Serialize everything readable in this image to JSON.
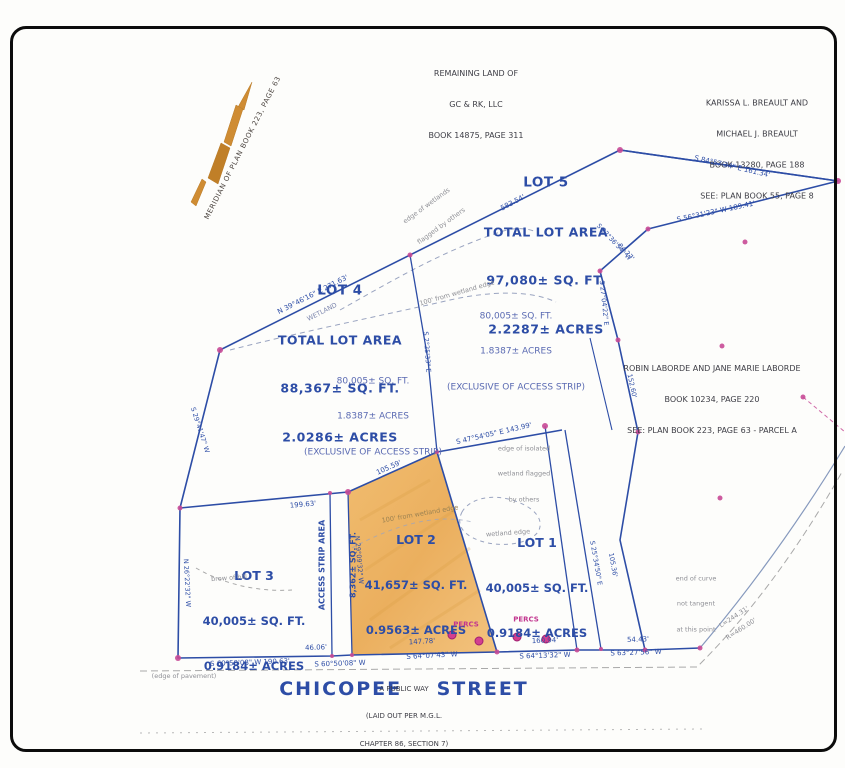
{
  "colors": {
    "ink_blue": "#2d4da6",
    "lot_fill_orange": "#edb266",
    "marker_pink": "#c2368f",
    "north_arrow_orange": "#cf8c33"
  },
  "abutters": {
    "remaining": [
      "REMAINING LAND OF",
      "GC & RK, LLC",
      "BOOK 14875, PAGE 311"
    ],
    "breault": [
      "KARISSA L. BREAULT AND",
      "MICHAEL J. BREAULT",
      "BOOK 13280, PAGE 188",
      "SEE: PLAN BOOK 55, PAGE 8"
    ],
    "laborde": [
      "ROBIN LABORDE AND JANE MARIE LABORDE",
      "BOOK 10234, PAGE 220",
      "SEE: PLAN BOOK 223, PAGE 63 - PARCEL A"
    ]
  },
  "parcels": {
    "lot5": {
      "title": "LOT 5",
      "lines": [
        "TOTAL LOT AREA",
        "97,080± SQ. FT.",
        "2.2287± ACRES"
      ]
    },
    "lot4": {
      "title": "LOT 4",
      "lines": [
        "TOTAL LOT AREA",
        "88,367± SQ. FT.",
        "2.0286± ACRES"
      ]
    },
    "lot5_net": [
      "80,005± SQ. FT.",
      "1.8387± ACRES",
      "(EXCLUSIVE OF ACCESS STRIP)"
    ],
    "lot4_net": [
      "80,005± SQ. FT.",
      "1.8387± ACRES",
      "(EXCLUSIVE OF ACCESS STRIP)"
    ],
    "lot2": {
      "title": "LOT 2",
      "lines": [
        "41,657± SQ. FT.",
        "0.9563± ACRES"
      ]
    },
    "lot1": {
      "title": "LOT 1",
      "lines": [
        "40,005± SQ. FT.",
        "0.9184± ACRES"
      ]
    },
    "lot3": {
      "title": "LOT 3",
      "lines": [
        "40,005± SQ. FT.",
        "0.9184± ACRES"
      ]
    },
    "access_strip": [
      "ACCESS STRIP AREA",
      "8,362± SQ. FT."
    ]
  },
  "street": {
    "name": "CHICOPEE    STREET",
    "sub": [
      "A PUBLIC WAY",
      "(LAID OUT PER M.G.L.",
      "CHAPTER 86, SECTION 7)"
    ]
  },
  "north_arrow": {
    "label": "MERIDIAN OF PLAN BOOK 223, PAGE 63"
  },
  "bearings": {
    "b161": "S 84°57'34\" E 161.34'",
    "b583": "583.54'",
    "b189": "S 56°31'23\" W 189.41'",
    "b2236": "S 22°36'54\" W",
    "b8427": "84.27'",
    "b2704": "S 27°04'22\" E",
    "b271": "N 39°46'16\" E 271.63'",
    "b14399": "S 47°54'05\" E 143.99'",
    "b10559": "105.59'",
    "b19963": "199.63'",
    "b19063": "S 60°50'08\" W 190.63'",
    "b4606": "46.06'",
    "b6050": "S 60°50'08\" W",
    "b14778": "147.78'",
    "b6407": "S 64°07'43\" W",
    "b16094": "160.94'",
    "b6413": "S 64°13'32\" W",
    "b5443": "54.43'",
    "b6327": "S 63°27'56\" W",
    "b2941": "S 29°41'47\" W",
    "b15260": "152.60'",
    "b2534": "S 25°34'50\" E",
    "b10536": "105.36'",
    "b2909": "N 29°09'32\" W",
    "b2622": "N 26°22'32\" W",
    "bdiv": "S 2°25'33\" E"
  },
  "notes": {
    "wetland": "WETLAND",
    "wl_others": [
      "edge of wetlands",
      "flagged by others"
    ],
    "wl_100": "100' from wetland edge",
    "wl_100b": "100' from wetland edge",
    "wl_iso": [
      "edge of isolated",
      "wetland flagged",
      "by others"
    ],
    "wl_edge": "wetland edge",
    "brow": "brow of hill",
    "pavement": "(edge of pavement)",
    "curve_note": [
      "end of curve",
      "not tangent",
      "at this point"
    ],
    "curve_l": "L=244.31'",
    "curve_r": "R=460.00'",
    "percs": "PERCS"
  }
}
